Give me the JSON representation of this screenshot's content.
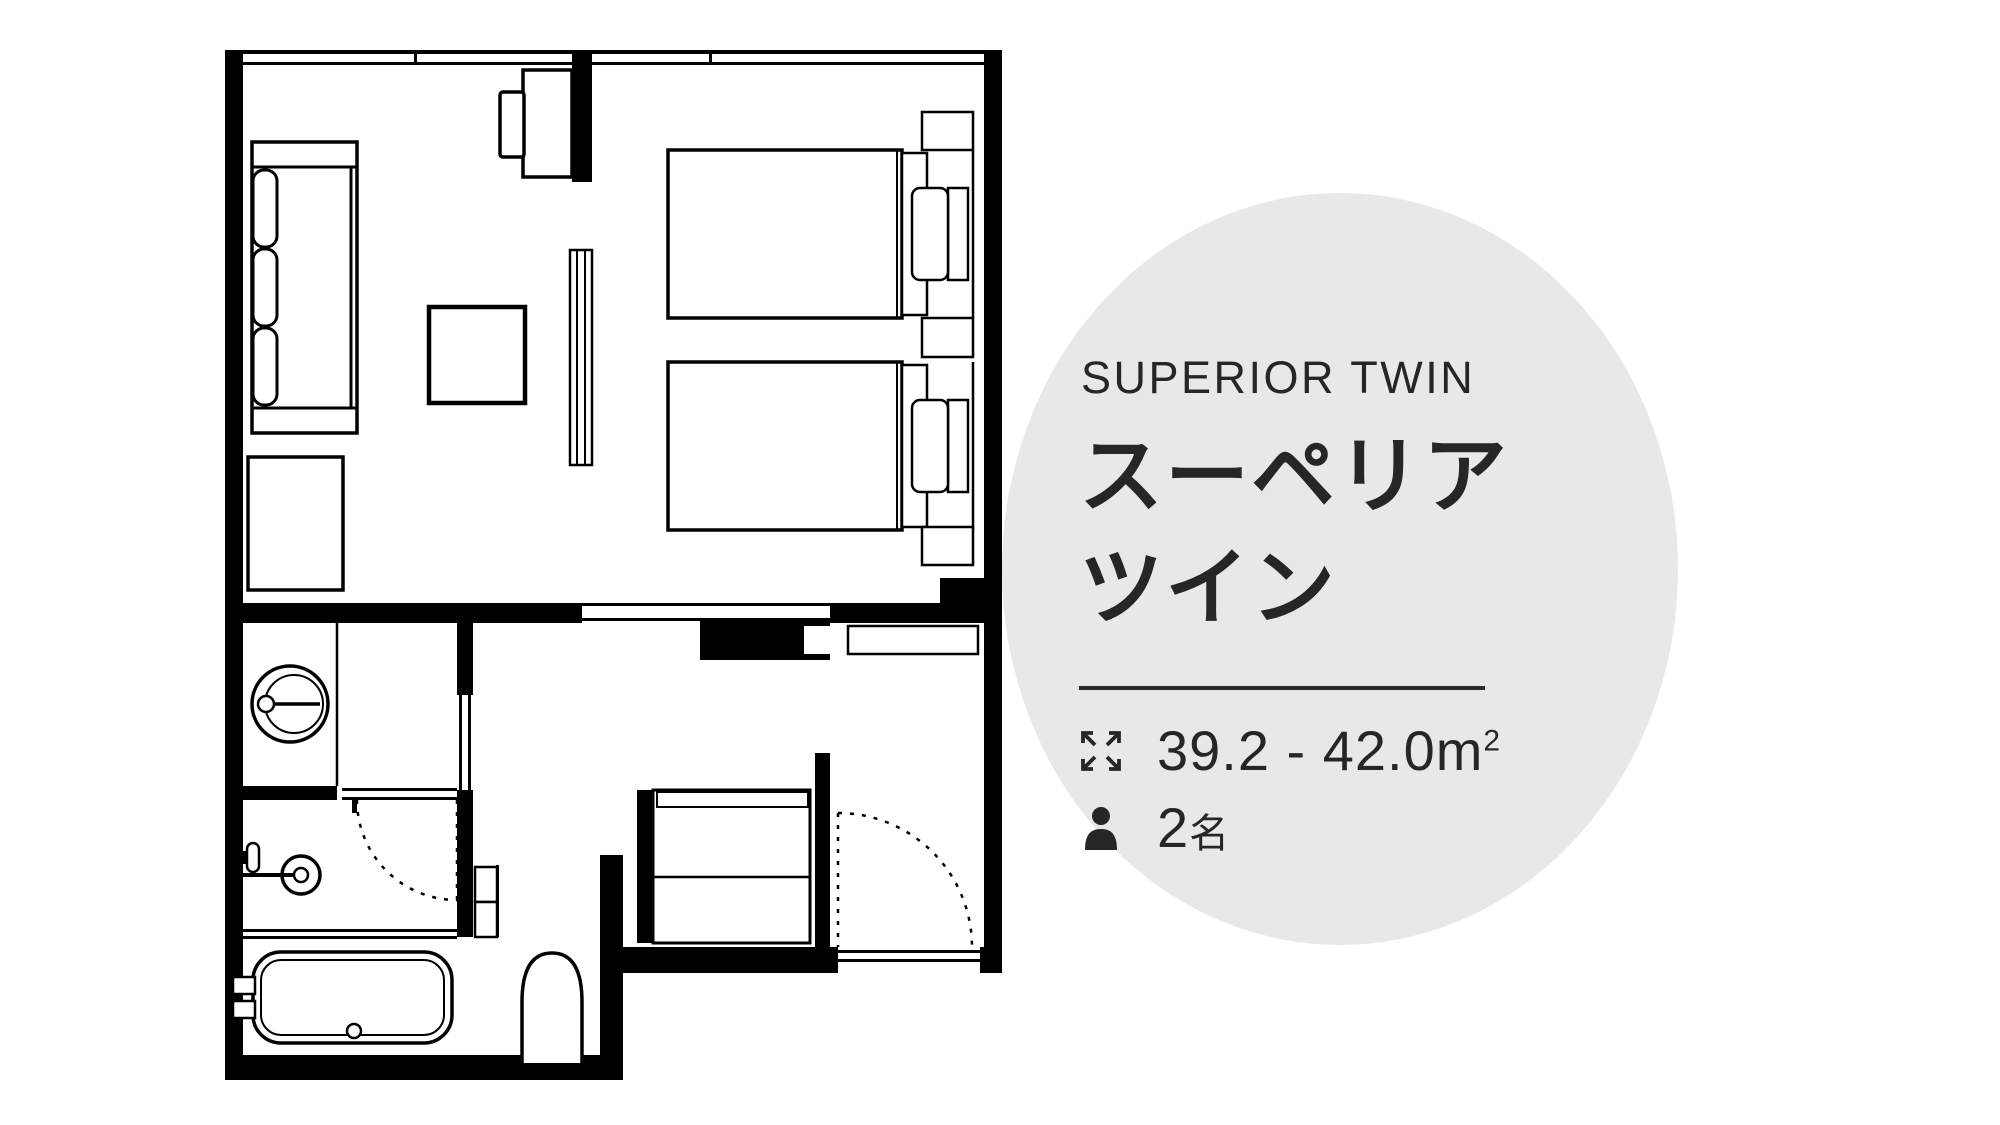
{
  "page": {
    "background_color": "#ffffff",
    "line_color": "#000000"
  },
  "panel": {
    "circle_color": "#e8e8e8",
    "text_color": "#262626",
    "divider_color": "#2b2b2b",
    "title_en": "SUPERIOR TWIN",
    "title_ja_line1": "スーペリア",
    "title_ja_line2": "ツイン",
    "area": {
      "icon": "expand-arrows-icon",
      "value": "39.2 - 42.0",
      "unit": "m",
      "sup": "2"
    },
    "guests": {
      "icon": "person-icon",
      "value": "2",
      "unit": "名"
    }
  },
  "floor_plan": {
    "type": "hotel-room-floor-plan",
    "features": [
      "sofa",
      "ottoman-table",
      "luggage-bench",
      "tv",
      "tv-cabinet",
      "media-board",
      "twin-bed-1",
      "twin-bed-2",
      "headboard-shelves",
      "windows",
      "washbasin",
      "vanity-counter",
      "shower-mixer",
      "bathtub",
      "toilet",
      "closet-shelves",
      "entrance-closet",
      "bathroom-door-swing",
      "entrance-door-swing"
    ]
  }
}
